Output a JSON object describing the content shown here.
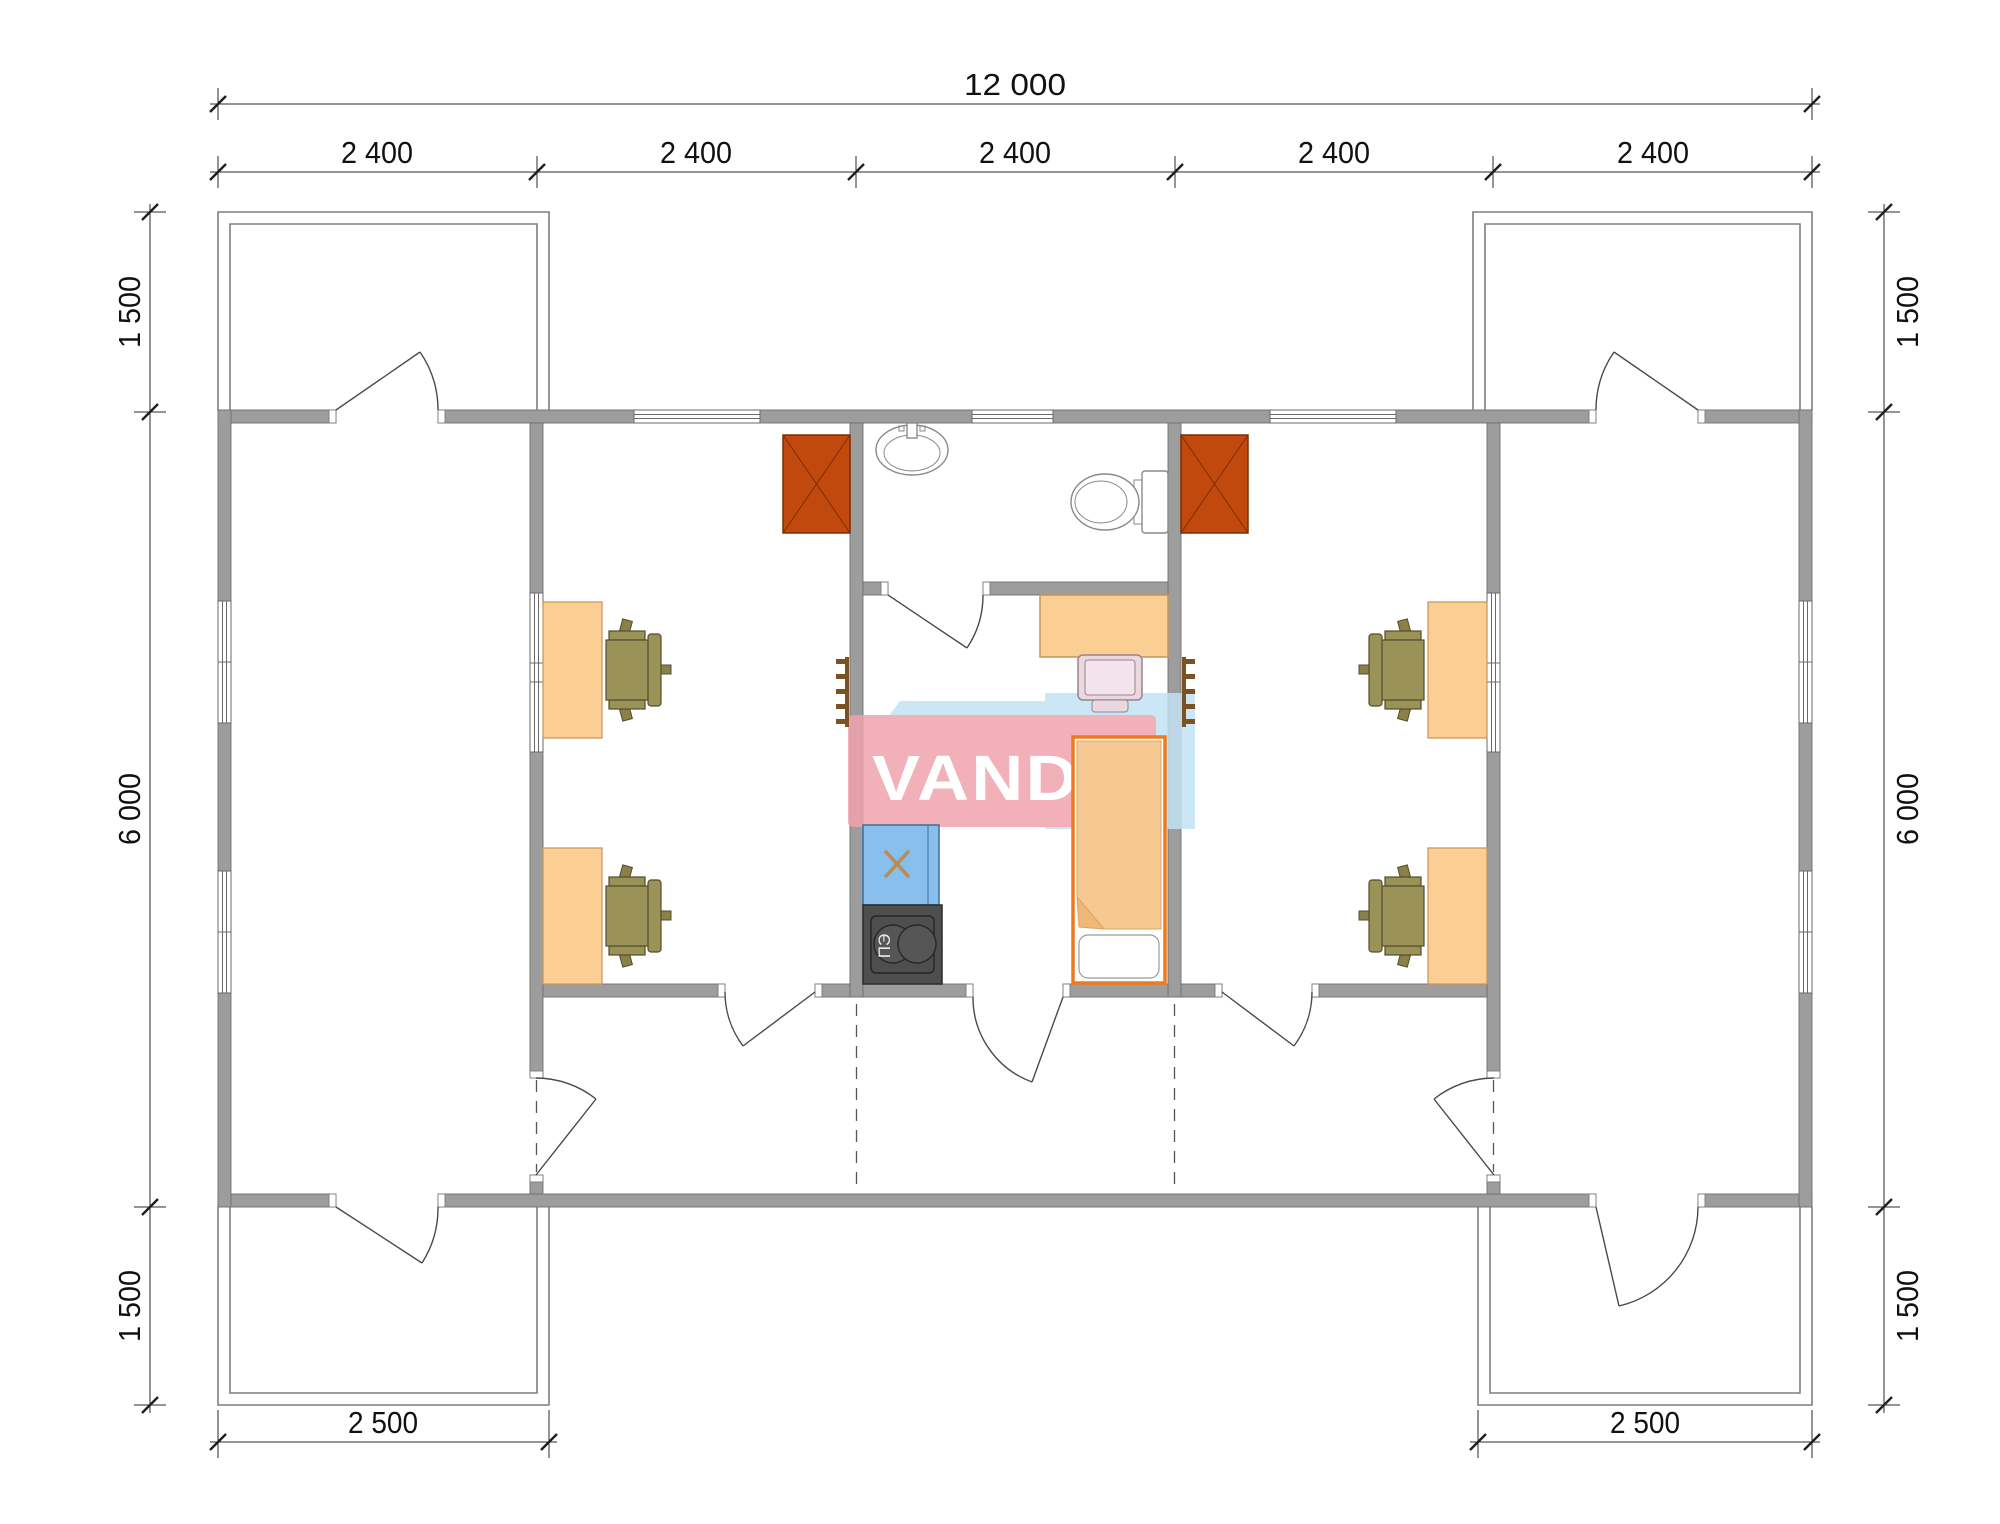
{
  "watermark": {
    "text": "VANDA"
  },
  "dimensions": {
    "top_total": "12 000",
    "top_segments": [
      "2 400",
      "2 400",
      "2 400",
      "2 400",
      "2 400"
    ],
    "left": {
      "top": "1 500",
      "middle": "6 000",
      "bottom": "1 500"
    },
    "right": {
      "top": "1 500",
      "middle": "6 000",
      "bottom": "1 500"
    },
    "bottom": {
      "left": "2 500",
      "right": "2 500"
    }
  },
  "labels": {
    "electric_stove": "ПЭ"
  },
  "colors": {
    "wall": "#9D9D9D",
    "furnace": "#C2490E",
    "desk": "#FBCE93",
    "office_chair": "#9A9257",
    "desk_chair": "#EAD7DF",
    "bed_frame": "#EE7A1E",
    "bed_blanket": "#F7C992",
    "sink_counter": "#88BFEC",
    "electric_stove": "#4E4E4E",
    "logo_pink": "#F0A3AC",
    "logo_blue": "#C3E2F4"
  }
}
